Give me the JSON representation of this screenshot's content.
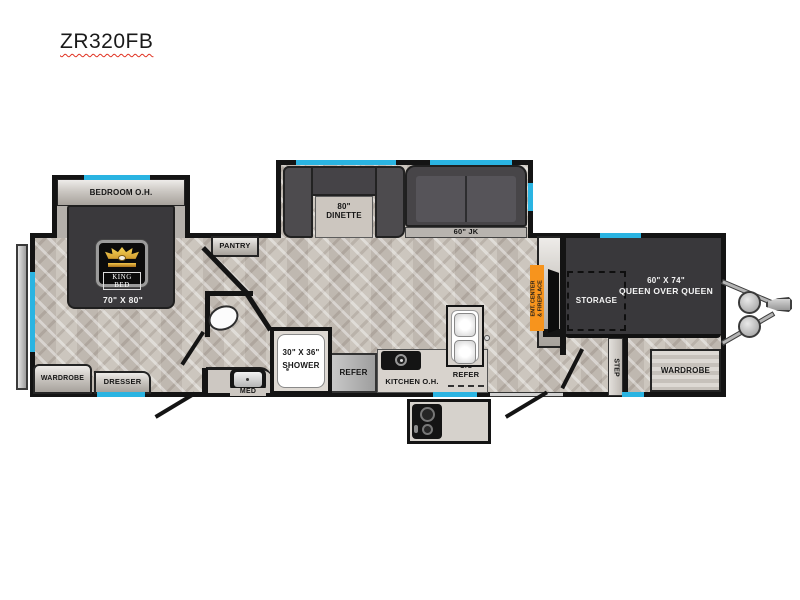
{
  "title": "ZR320FB",
  "colors": {
    "wall": "#141414",
    "window_accent": "#2ab4e2",
    "floor": "#c8c1b9",
    "bed_dark": "#3a393c",
    "sofa_dark": "#4a484b",
    "counter_light": "#d8d3cd",
    "ent_center_orange": "#f7941d",
    "appliance_gray": "#b5b3b1",
    "crown_gold": "#e9b33c"
  },
  "labels": {
    "bedroom_oh": "BEDROOM O.H.",
    "king_bed": "KING BED",
    "king_bed_size": "70\" X 80\"",
    "pantry": "PANTRY",
    "dinette_size": "80\"",
    "dinette": "DINETTE",
    "sofa": "60\" JK",
    "ent_center_line1": "ENT. CENTER",
    "ent_center_line2": "& FIREPLACE",
    "storage": "STORAGE",
    "bunk_size": "60\" X 74\"",
    "bunk": "QUEEN OVER QUEEN",
    "step": "STEP",
    "wardrobe_bunk": "WARDROBE",
    "wardrobe_bedroom": "WARDROBE",
    "dresser": "DRESSER",
    "shower_size": "30\" X 36\"",
    "shower": "SHOWER",
    "med": "MED",
    "refer": "REFER",
    "kitchen_oh": "KITCHEN O.H.",
    "os_refer_line1": "O/S",
    "os_refer_line2": "REFER"
  }
}
